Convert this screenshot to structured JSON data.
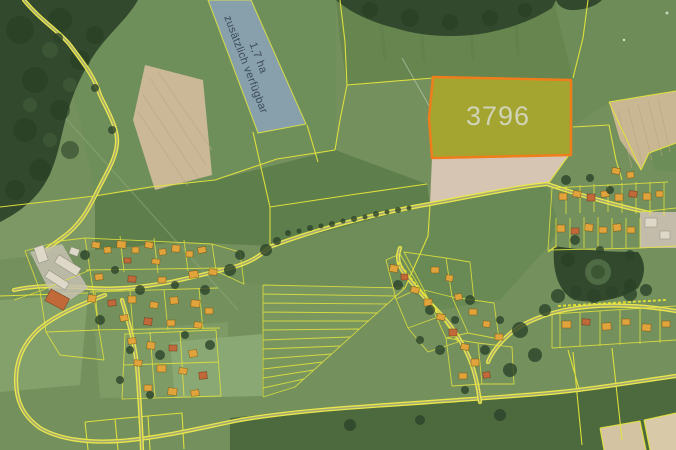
{
  "map": {
    "highlighted_parcel": {
      "label": "3796",
      "border_color": "#ef7d1c",
      "fill_color": "#a4a530",
      "label_color": "#d9dcce"
    },
    "available_parcel": {
      "area": "1,7 ha",
      "note": "zusätzlich verfügbar",
      "fill_color": "#8aa2b2",
      "text_color": "#3d4b58"
    },
    "boundary_color": "#e4e43c",
    "road_color": "#eae74a"
  }
}
